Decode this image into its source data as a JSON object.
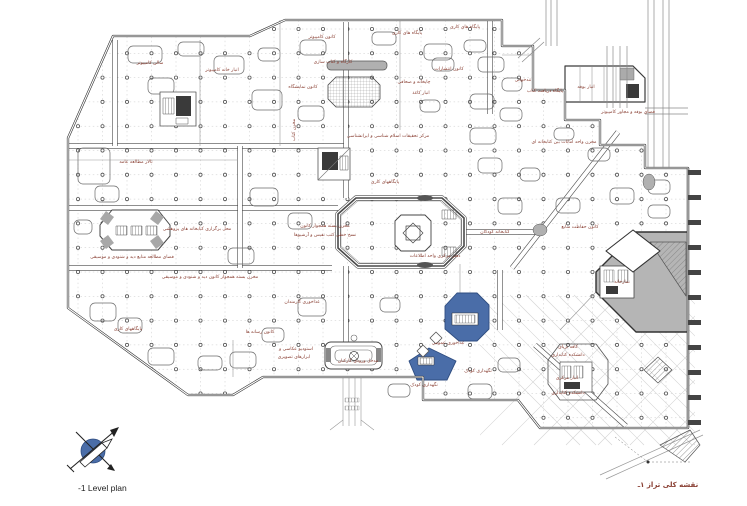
{
  "page": {
    "title_en": "-1 Level plan",
    "caption_fa": "نقشه کلی تراز ۱ـ"
  },
  "colors": {
    "blue": "#4a6da8",
    "blue_dark": "#2f4d80",
    "line": "#3c3c3c",
    "line_light": "#8a8a8a",
    "grid_dash": "#c8c8c8",
    "dot_stroke": "#555555",
    "label": "#8a4034",
    "gray_fill": "#b5b5b5",
    "dark_fill": "#3a3a3a",
    "street": "#d4d4d4"
  },
  "plan": {
    "label_size": 4.6,
    "grid": {
      "x0": 78,
      "dx": 24.5,
      "cols": 25,
      "y0": 29,
      "dy": 24.3,
      "rows": 17
    },
    "comb": {
      "x": 688,
      "y0": 170,
      "step": 25,
      "count": 11,
      "w": 13,
      "h": 5
    },
    "labels": [
      {
        "t": "سالن کامپیوتر",
        "x": 150,
        "y": 64
      },
      {
        "t": "انبار خانه کامپیوتر",
        "x": 222,
        "y": 71
      },
      {
        "t": "کانون کامپیوتر",
        "x": 322,
        "y": 38
      },
      {
        "t": "پایگاه های کاری",
        "x": 407,
        "y": 34
      },
      {
        "t": "پایگاه های کاری",
        "x": 465,
        "y": 28
      },
      {
        "t": "کارگاه و کتاب سازی",
        "x": 333,
        "y": 63
      },
      {
        "t": "کانون نمایشگاه",
        "x": 303,
        "y": 88
      },
      {
        "t": "کانون انتشارات",
        "x": 449,
        "y": 70
      },
      {
        "t": "چاپخانه و صحافی",
        "x": 414,
        "y": 83
      },
      {
        "t": "انبار کاغذ",
        "x": 421,
        "y": 94
      },
      {
        "t": "تندخوانی",
        "x": 523,
        "y": 81
      },
      {
        "t": "پایگاه دریافت کتاب",
        "x": 545,
        "y": 92
      },
      {
        "t": "انبار بوفه",
        "x": 586,
        "y": 88
      },
      {
        "t": "فضای بوفه و مجاور کامپیوتر",
        "x": 628,
        "y": 113
      },
      {
        "t": "مرکز تحقیقات اسلام شناسی و ایرانشناسی",
        "x": 388,
        "y": 137
      },
      {
        "t": "تالار مطالعه عامه",
        "x": 136,
        "y": 163
      },
      {
        "t": "مخزن کتاب",
        "x": 295,
        "y": 130,
        "r": -90
      },
      {
        "t": "پایگاههای کاری",
        "x": 385,
        "y": 183
      },
      {
        "t": "مخزن بسته همجوار کانون",
        "x": 325,
        "y": 227
      },
      {
        "t": "نسخ خطی کتب نفیس و آرشیوها",
        "x": 325,
        "y": 236
      },
      {
        "t": "مخزن واحد امانات بین کتابخانه ای",
        "x": 564,
        "y": 143
      },
      {
        "t": "کانون حفاظت منابع",
        "x": 580,
        "y": 228
      },
      {
        "t": "کتابخانه کودکان",
        "x": 495,
        "y": 233
      },
      {
        "t": "دفتر مرکزی واحد اطلاعات",
        "x": 435,
        "y": 257
      },
      {
        "t": "محل برگزاری کتابخانه های پژوهشی",
        "x": 197,
        "y": 230
      },
      {
        "t": "فضای مطالعه منابع دید و شنودی و موسیقی",
        "x": 132,
        "y": 258
      },
      {
        "t": "مخزن بسته همجوار کانون دید و شنودی و موسیقی",
        "x": 210,
        "y": 278
      },
      {
        "t": "پایگاههای کاری",
        "x": 128,
        "y": 330
      },
      {
        "t": "کانون رسانه ها",
        "x": 260,
        "y": 333
      },
      {
        "t": "استودیو عکاسی و",
        "x": 296,
        "y": 350
      },
      {
        "t": "ابزارهای تصویری",
        "x": 294,
        "y": 358
      },
      {
        "t": "غذاخوری کارمندان",
        "x": 302,
        "y": 303
      },
      {
        "t": "مدخل ورودی کارکنان",
        "x": 358,
        "y": 362
      },
      {
        "t": "غذاخوری عمومی",
        "x": 448,
        "y": 344
      },
      {
        "t": "نگهداری کودک",
        "x": 478,
        "y": 372
      },
      {
        "t": "نگهداری کودک",
        "x": 424,
        "y": 386
      },
      {
        "t": "نمازخانه",
        "x": 622,
        "y": 283
      },
      {
        "t": "کافه تریای",
        "x": 568,
        "y": 348
      },
      {
        "t": "دانشکده کتابداری",
        "x": 568,
        "y": 356
      },
      {
        "t": "انبار مرکزی",
        "x": 567,
        "y": 379
      },
      {
        "t": "دانشکده کتابداری",
        "x": 568,
        "y": 394
      }
    ]
  },
  "compass": {
    "name": "north-arrow"
  }
}
